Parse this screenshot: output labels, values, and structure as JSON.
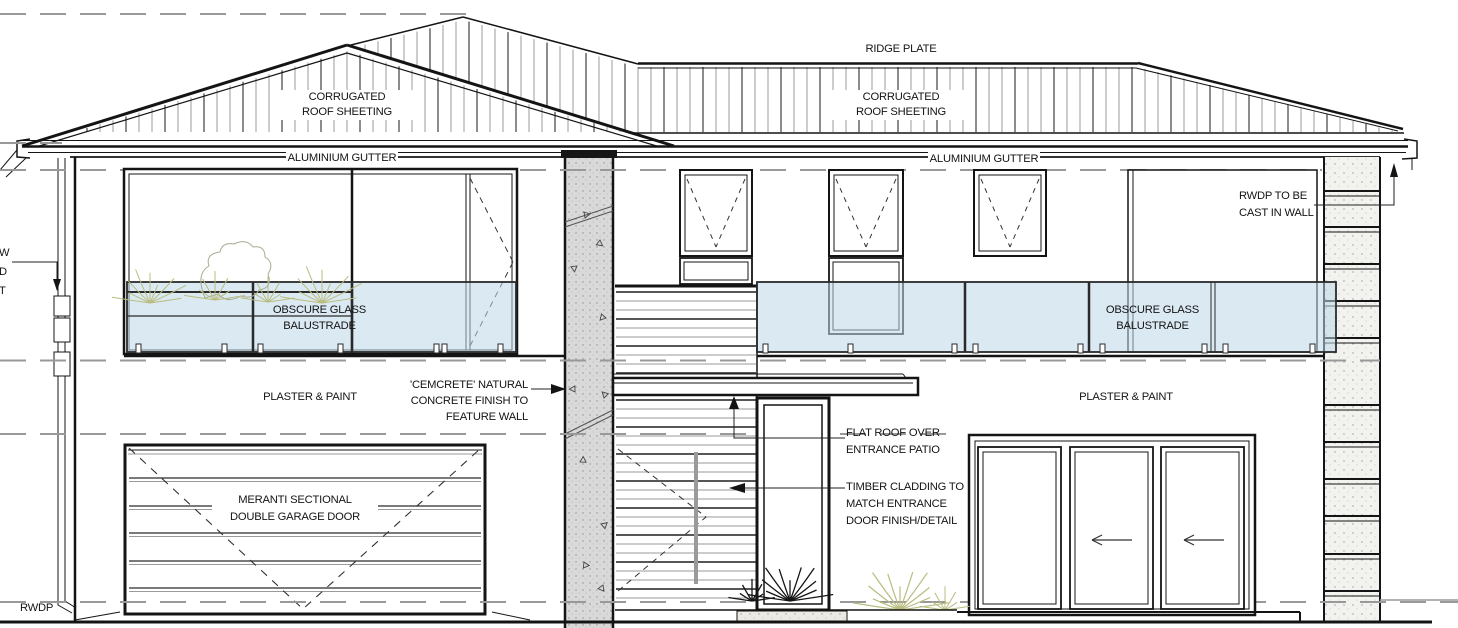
{
  "drawing": {
    "type": "house-front-elevation",
    "sheet_background": "#ffffff"
  },
  "colors": {
    "line": "#141414",
    "grey_line": "#8a8a8a",
    "glass_balustrade": "#bdd7ea",
    "concrete_feature_wall": "#d9d9d9",
    "stone_pier": "#f2f2ee",
    "plant_olive": "#b9bc7e",
    "plant_black": "#151515"
  },
  "labels": {
    "ridge_plate": "RIDGE PLATE",
    "corrugated_roof_left": "CORRUGATED\nROOF SHEETING",
    "corrugated_roof_right": "CORRUGATED\nROOF SHEETING",
    "aluminium_gutter_left": "ALUMINIUM GUTTER",
    "aluminium_gutter_right": "ALUMINIUM GUTTER",
    "rwdp_cast_in_wall": "RWDP TO BE\nCAST IN WALL",
    "obscure_glass_left": "OBSCURE GLASS\nBALUSTRADE",
    "obscure_glass_right": "OBSCURE GLASS\nBALUSTRADE",
    "plaster_paint_left": "PLASTER & PAINT",
    "plaster_paint_right": "PLASTER & PAINT",
    "cemcrete_feature_wall": "'CEMCRETE' NATURAL\nCONCRETE FINISH TO\nFEATURE WALL",
    "flat_roof_patio": "FLAT ROOF OVER\nENTRANCE PATIO",
    "timber_cladding": "TIMBER CLADDING TO\nMATCH ENTRANCE\nDOOR FINISH/DETAIL",
    "garage_door": "MERANTI SECTIONAL\nDOUBLE GARAGE DOOR",
    "rwdp": "RWDP",
    "left_edge_cutoff": "W\nD\nT"
  }
}
